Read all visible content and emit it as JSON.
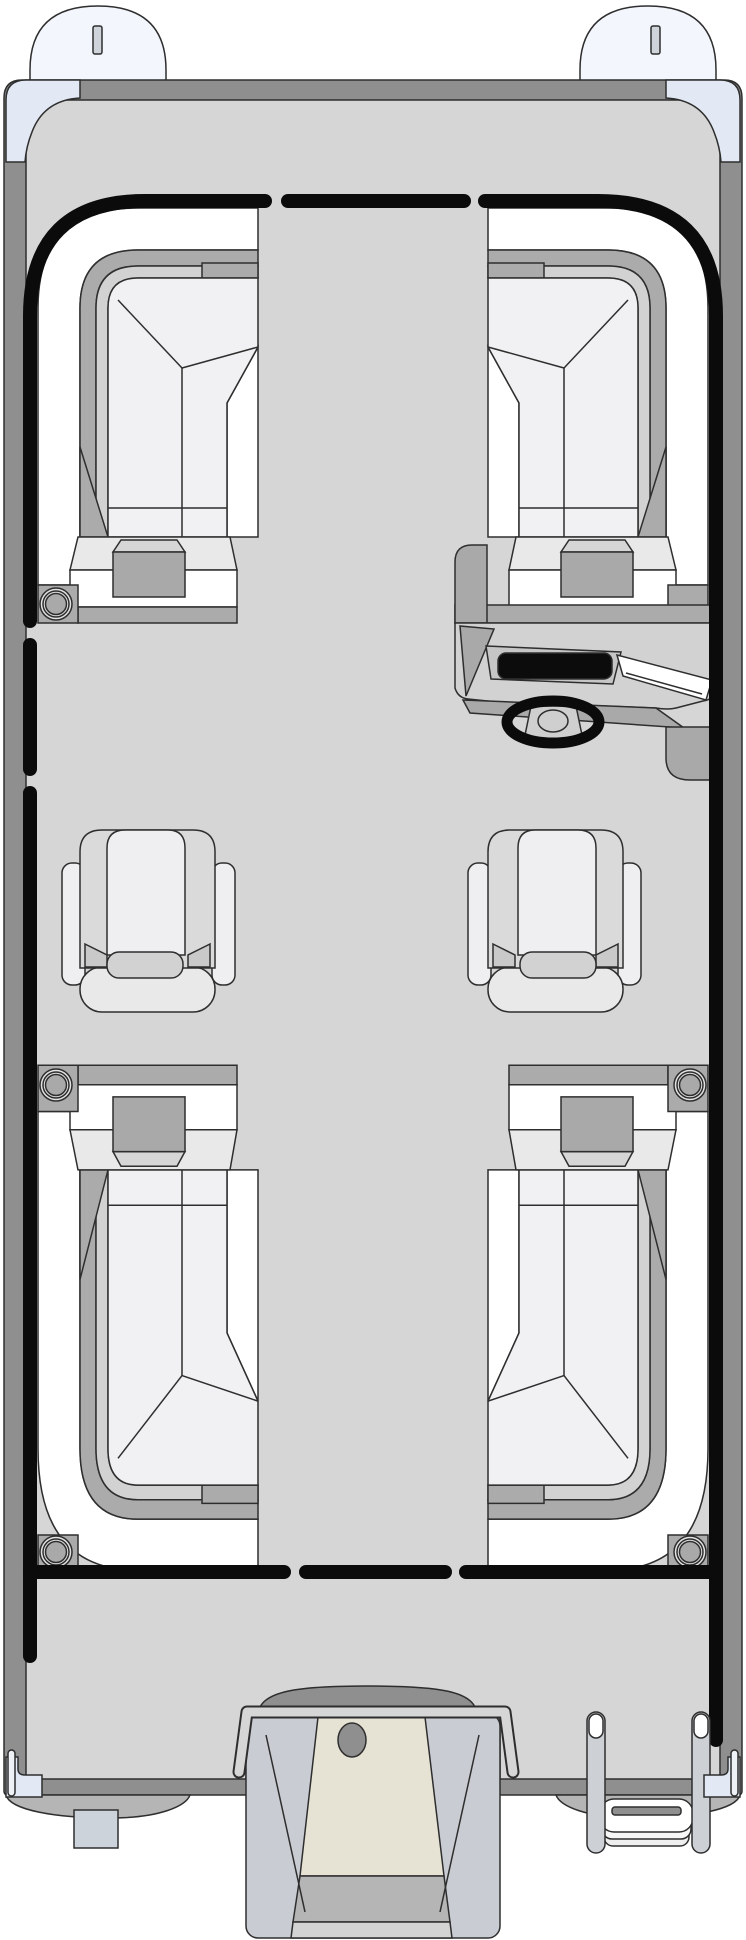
{
  "diagram": {
    "kind": "pontoon-boat-floorplan",
    "view": "top-down",
    "width_px": 746,
    "height_px": 1940
  },
  "inventory": {
    "nose_cones": 2,
    "bow_lounges": 2,
    "stern_lounges": 2,
    "captain_chairs": 2,
    "cup_trays": 4,
    "cupholder_rings": 5,
    "bow_gate_gaps": 2,
    "stern_gate_gaps": 2,
    "helm_console": 1,
    "steering_wheel": 1,
    "dashboard_screen": 1,
    "windshield": 1,
    "outboard_motor": 1,
    "motor_mount_bracket": 1,
    "boarding_ladder_rails": 2,
    "ladder_folded_steps": 3,
    "pontoon_tubes": 2,
    "corner_caps": 4
  },
  "colors": {
    "line": "#2e2e2e",
    "fence": "#0b0b0b",
    "deck": "#d6d6d6",
    "rim": "#8f8f8f",
    "nose_cone": "#f3f6fc",
    "slot": "#cfd3da",
    "corner_cap": "#e2e9f4",
    "pin": "#eef1f6",
    "seat_white": "#ffffff",
    "band_medium": "#ababab",
    "band_light": "#d2d2d2",
    "cushion": "#f1f1f3",
    "platform": "#e9e9e9",
    "tray": "#a9a9a9",
    "tray_lid": "#d6d6d6",
    "console": "#d2d2d2",
    "console_dark": "#a9a9a9",
    "dash_panel": "#c6c6c6",
    "screen": "#0c0c0c",
    "hub": "#cfcfcf",
    "chair_wing": "#dadada",
    "chair_panel": "#efeff1",
    "chair_seat": "#e9e9e9",
    "chair_join": "#d2d2d2",
    "chair_gray": "#c9c9c9",
    "motor_pod": "#c9cdd3",
    "motor_cowl": "#8f8f8f",
    "motor_body": "#e7e3d4",
    "motor_band": "#b5b5b5",
    "motor_lower": "#d3d3d3",
    "pontoon": "#b5b5b5",
    "transducer": "#cdd3da",
    "ladder": "#cdd1d6",
    "bracket": "#d6d6d6",
    "ring_outer": "#e2e2e2",
    "ring_inner": "#a9a9a9"
  }
}
